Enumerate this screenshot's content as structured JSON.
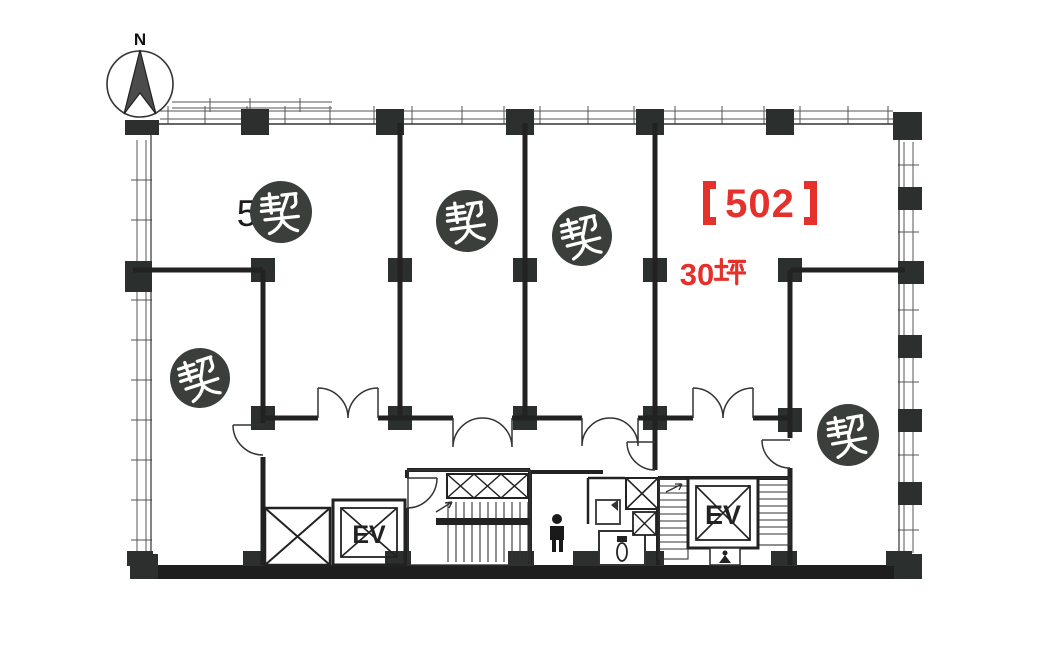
{
  "compass": {
    "label": "N"
  },
  "unit": {
    "display": "【502】",
    "number": "502",
    "area": "30坪",
    "area_number": "30",
    "area_unit": "坪"
  },
  "labels": {
    "contract_seal": "契",
    "elevator": "EV",
    "partial_room_number": "5"
  },
  "seals": {
    "count": 5
  },
  "colors": {
    "highlight": "#e5312b",
    "seal_circle": "#3a3f3c",
    "wall": "#222222"
  }
}
